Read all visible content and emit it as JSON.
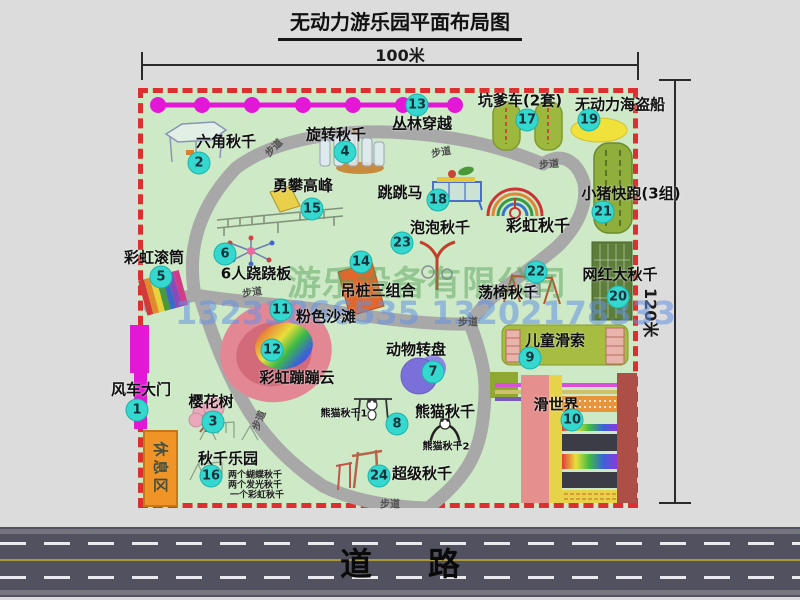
{
  "title": "无动力游乐园平面布局图",
  "dimensions": {
    "width_label": "100米",
    "height_label": "120米"
  },
  "road": {
    "label": "道路"
  },
  "watermark": {
    "company": "游乐设备有限公司",
    "phone": "13233866535 13202178333"
  },
  "rest_area_label": "休息区",
  "trail_text": "步道",
  "attractions": [
    {
      "n": 1,
      "label": "风车大门",
      "x": 137,
      "y": 410,
      "lx": 141,
      "ly": 389
    },
    {
      "n": 2,
      "label": "六角秋千",
      "x": 199,
      "y": 163,
      "lx": 226,
      "ly": 141
    },
    {
      "n": 3,
      "label": "樱花树",
      "x": 213,
      "y": 422,
      "lx": 211,
      "ly": 401
    },
    {
      "n": 4,
      "label": "旋转秋千",
      "x": 345,
      "y": 152,
      "lx": 336,
      "ly": 134
    },
    {
      "n": 5,
      "label": "彩虹滚筒",
      "x": 161,
      "y": 277,
      "lx": 154,
      "ly": 257
    },
    {
      "n": 6,
      "label": "6人跷跷板",
      "x": 225,
      "y": 254,
      "lx": 256,
      "ly": 273
    },
    {
      "n": 7,
      "label": "动物转盘",
      "x": 433,
      "y": 372,
      "lx": 416,
      "ly": 349
    },
    {
      "n": 8,
      "label": "熊猫秋千",
      "x": 397,
      "y": 424,
      "lx": 445,
      "ly": 411
    },
    {
      "n": 9,
      "label": "儿童滑索",
      "x": 530,
      "y": 358,
      "lx": 555,
      "ly": 340
    },
    {
      "n": 10,
      "label": "滑世界",
      "x": 572,
      "y": 420,
      "lx": 556,
      "ly": 404
    },
    {
      "n": 11,
      "label": "粉色沙滩",
      "x": 281,
      "y": 310,
      "lx": 326,
      "ly": 316
    },
    {
      "n": 12,
      "label": "彩虹蹦蹦云",
      "x": 272,
      "y": 350,
      "lx": 297,
      "ly": 377
    },
    {
      "n": 13,
      "label": "丛林穿越",
      "x": 417,
      "y": 105,
      "lx": 422,
      "ly": 123
    },
    {
      "n": 14,
      "label": "吊桩三组合",
      "x": 361,
      "y": 262,
      "lx": 378,
      "ly": 290
    },
    {
      "n": 15,
      "label": "勇攀高峰",
      "x": 312,
      "y": 209,
      "lx": 303,
      "ly": 185
    },
    {
      "n": 16,
      "label": "秋千乐园",
      "x": 211,
      "y": 476,
      "lx": 228,
      "ly": 458
    },
    {
      "n": 17,
      "label": "坑爹车(2套)",
      "x": 527,
      "y": 120,
      "lx": 520,
      "ly": 100
    },
    {
      "n": 18,
      "label": "跳跳马",
      "x": 438,
      "y": 200,
      "lx": 400,
      "ly": 192
    },
    {
      "n": 19,
      "label": "无动力海盗船",
      "x": 589,
      "y": 120,
      "lx": 620,
      "ly": 104
    },
    {
      "n": 20,
      "label": "网红大秋千",
      "x": 618,
      "y": 297,
      "lx": 620,
      "ly": 274
    },
    {
      "n": 21,
      "label": "小猪快跑(3组)",
      "x": 603,
      "y": 212,
      "lx": 631,
      "ly": 193
    },
    {
      "n": 22,
      "label": "荡椅秋千",
      "x": 536,
      "y": 272,
      "lx": 508,
      "ly": 292
    },
    {
      "n": 23,
      "label": "泡泡秋千",
      "x": 402,
      "y": 243,
      "lx": 440,
      "ly": 227
    },
    {
      "n": 24,
      "label": "超级秋千",
      "x": 379,
      "y": 476,
      "lx": 422,
      "ly": 473
    }
  ],
  "extra_labels": [
    {
      "text": "彩虹秋千",
      "x": 538,
      "y": 224,
      "size": 16
    },
    {
      "text": "熊猫秋千1",
      "x": 344,
      "y": 412,
      "size": 10
    },
    {
      "text": "熊猫秋千2",
      "x": 446,
      "y": 445,
      "size": 10
    }
  ],
  "swing_park_notes": [
    {
      "text": "两个蝴蝶秋千",
      "x": 228,
      "y": 474
    },
    {
      "text": "两个发光秋千",
      "x": 228,
      "y": 484
    },
    {
      "text": "一个彩虹秋千",
      "x": 230,
      "y": 494
    }
  ],
  "trail_labels": [
    {
      "x": 273,
      "y": 147,
      "rot": -45
    },
    {
      "x": 441,
      "y": 151,
      "rot": -10
    },
    {
      "x": 549,
      "y": 163,
      "rot": -5
    },
    {
      "x": 252,
      "y": 291,
      "rot": -8
    },
    {
      "x": 468,
      "y": 321,
      "rot": 0
    },
    {
      "x": 258,
      "y": 420,
      "rot": -68
    },
    {
      "x": 390,
      "y": 503,
      "rot": 0
    }
  ],
  "jungle_line": {
    "y": 105,
    "x1": 152,
    "x2": 460,
    "dot_xs": [
      158,
      202,
      252,
      303,
      353,
      403,
      455
    ]
  }
}
